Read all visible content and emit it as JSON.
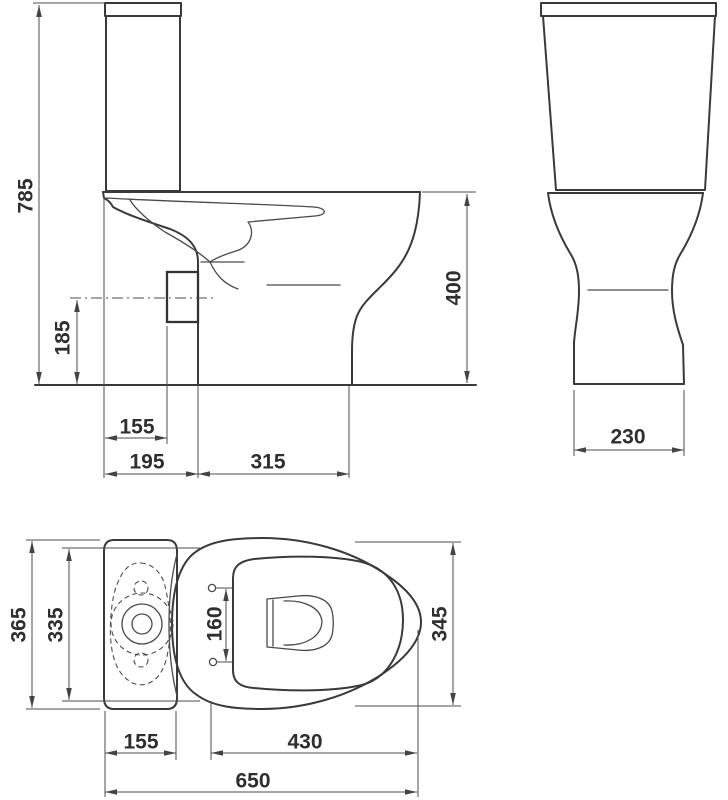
{
  "drawing": {
    "colors": {
      "background": "#ffffff",
      "outline": "#3a3a3a",
      "dimension_lines": "#4d4d4d",
      "labels": "#2f2f2f"
    },
    "side_view": {
      "overall_height": "785",
      "outlet_axis_height": "185",
      "wall_to_outlet": "155",
      "wall_to_base": "195",
      "base_length": "315",
      "rim_height": "400"
    },
    "front_view": {
      "base_width": "230"
    },
    "plan_view": {
      "cistern_width": "365",
      "body_width": "335",
      "seat_hole_spacing": "160",
      "bowl_width": "345",
      "cistern_depth": "155",
      "bowl_length": "430",
      "overall_depth": "650"
    }
  }
}
